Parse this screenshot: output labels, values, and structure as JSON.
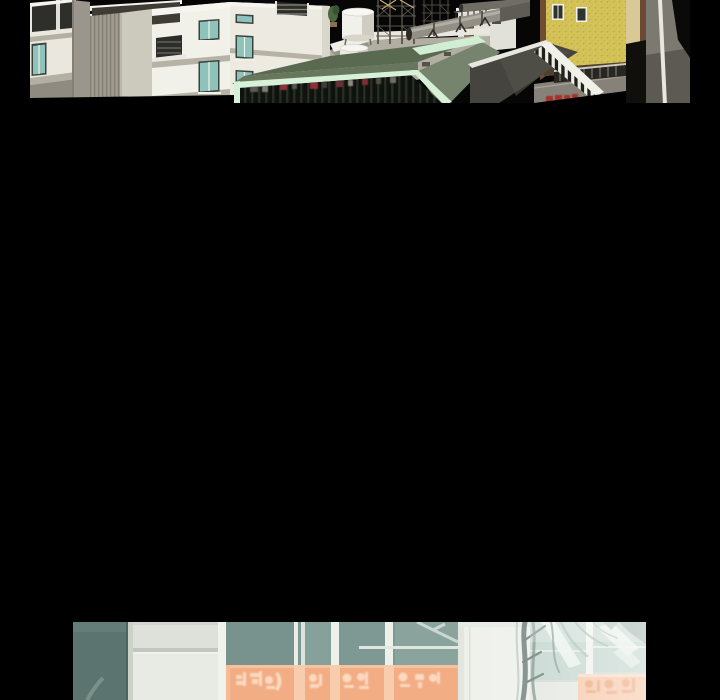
{
  "page": {
    "kind": "webtoon-episode-viewer",
    "background_color": "#000000",
    "visible_text": []
  },
  "panels": {
    "top": {
      "alt": "Cut-off comic panel: 3D-rendered city block with white apartment buildings with teal windows, a rooftop holding water tanks, scaffold towers and large grey pipes, a sage-green building with mint trim and dark slatted front, a yellow speckled brick building over a street with a dark railing and a small red sign",
      "palette": {
        "facade_white": "#f1f0e9",
        "window_teal": "#8fc2ba",
        "roof_sage": "#67775d",
        "trim_mint": "#d6f1d8",
        "brick_yellow": "#d3c358",
        "roof_charcoal": "#45443e",
        "street_gray": "#86827a",
        "sign_red": "#a8322a"
      }
    },
    "bottom": {
      "alt": "Cut-off comic panel: storefront with a slate panel, white pilaster, teal glass windows with white mullions, a row of orange signs bearing blurred illegible glyphs, and bare branches before a washed-out pale right side",
      "signage": {
        "style": "blurred illegible glyphs",
        "sign_color": "#f2ad85",
        "glyph_color": "#fcd9bf"
      },
      "palette": {
        "slate_panel": "#5c7470",
        "glass_teal": "#7e9993",
        "glass_pale": "#c2d4ce",
        "mullion_white": "#f0f3ec",
        "sign_orange": "#f2ad85",
        "sign_orange_pale": "#f6c5a4",
        "glyph_light": "#fcd9bf",
        "glyph_dark": "#eba173",
        "branch_dark": "#647470",
        "panel_white": "#e8ebe3"
      }
    }
  }
}
